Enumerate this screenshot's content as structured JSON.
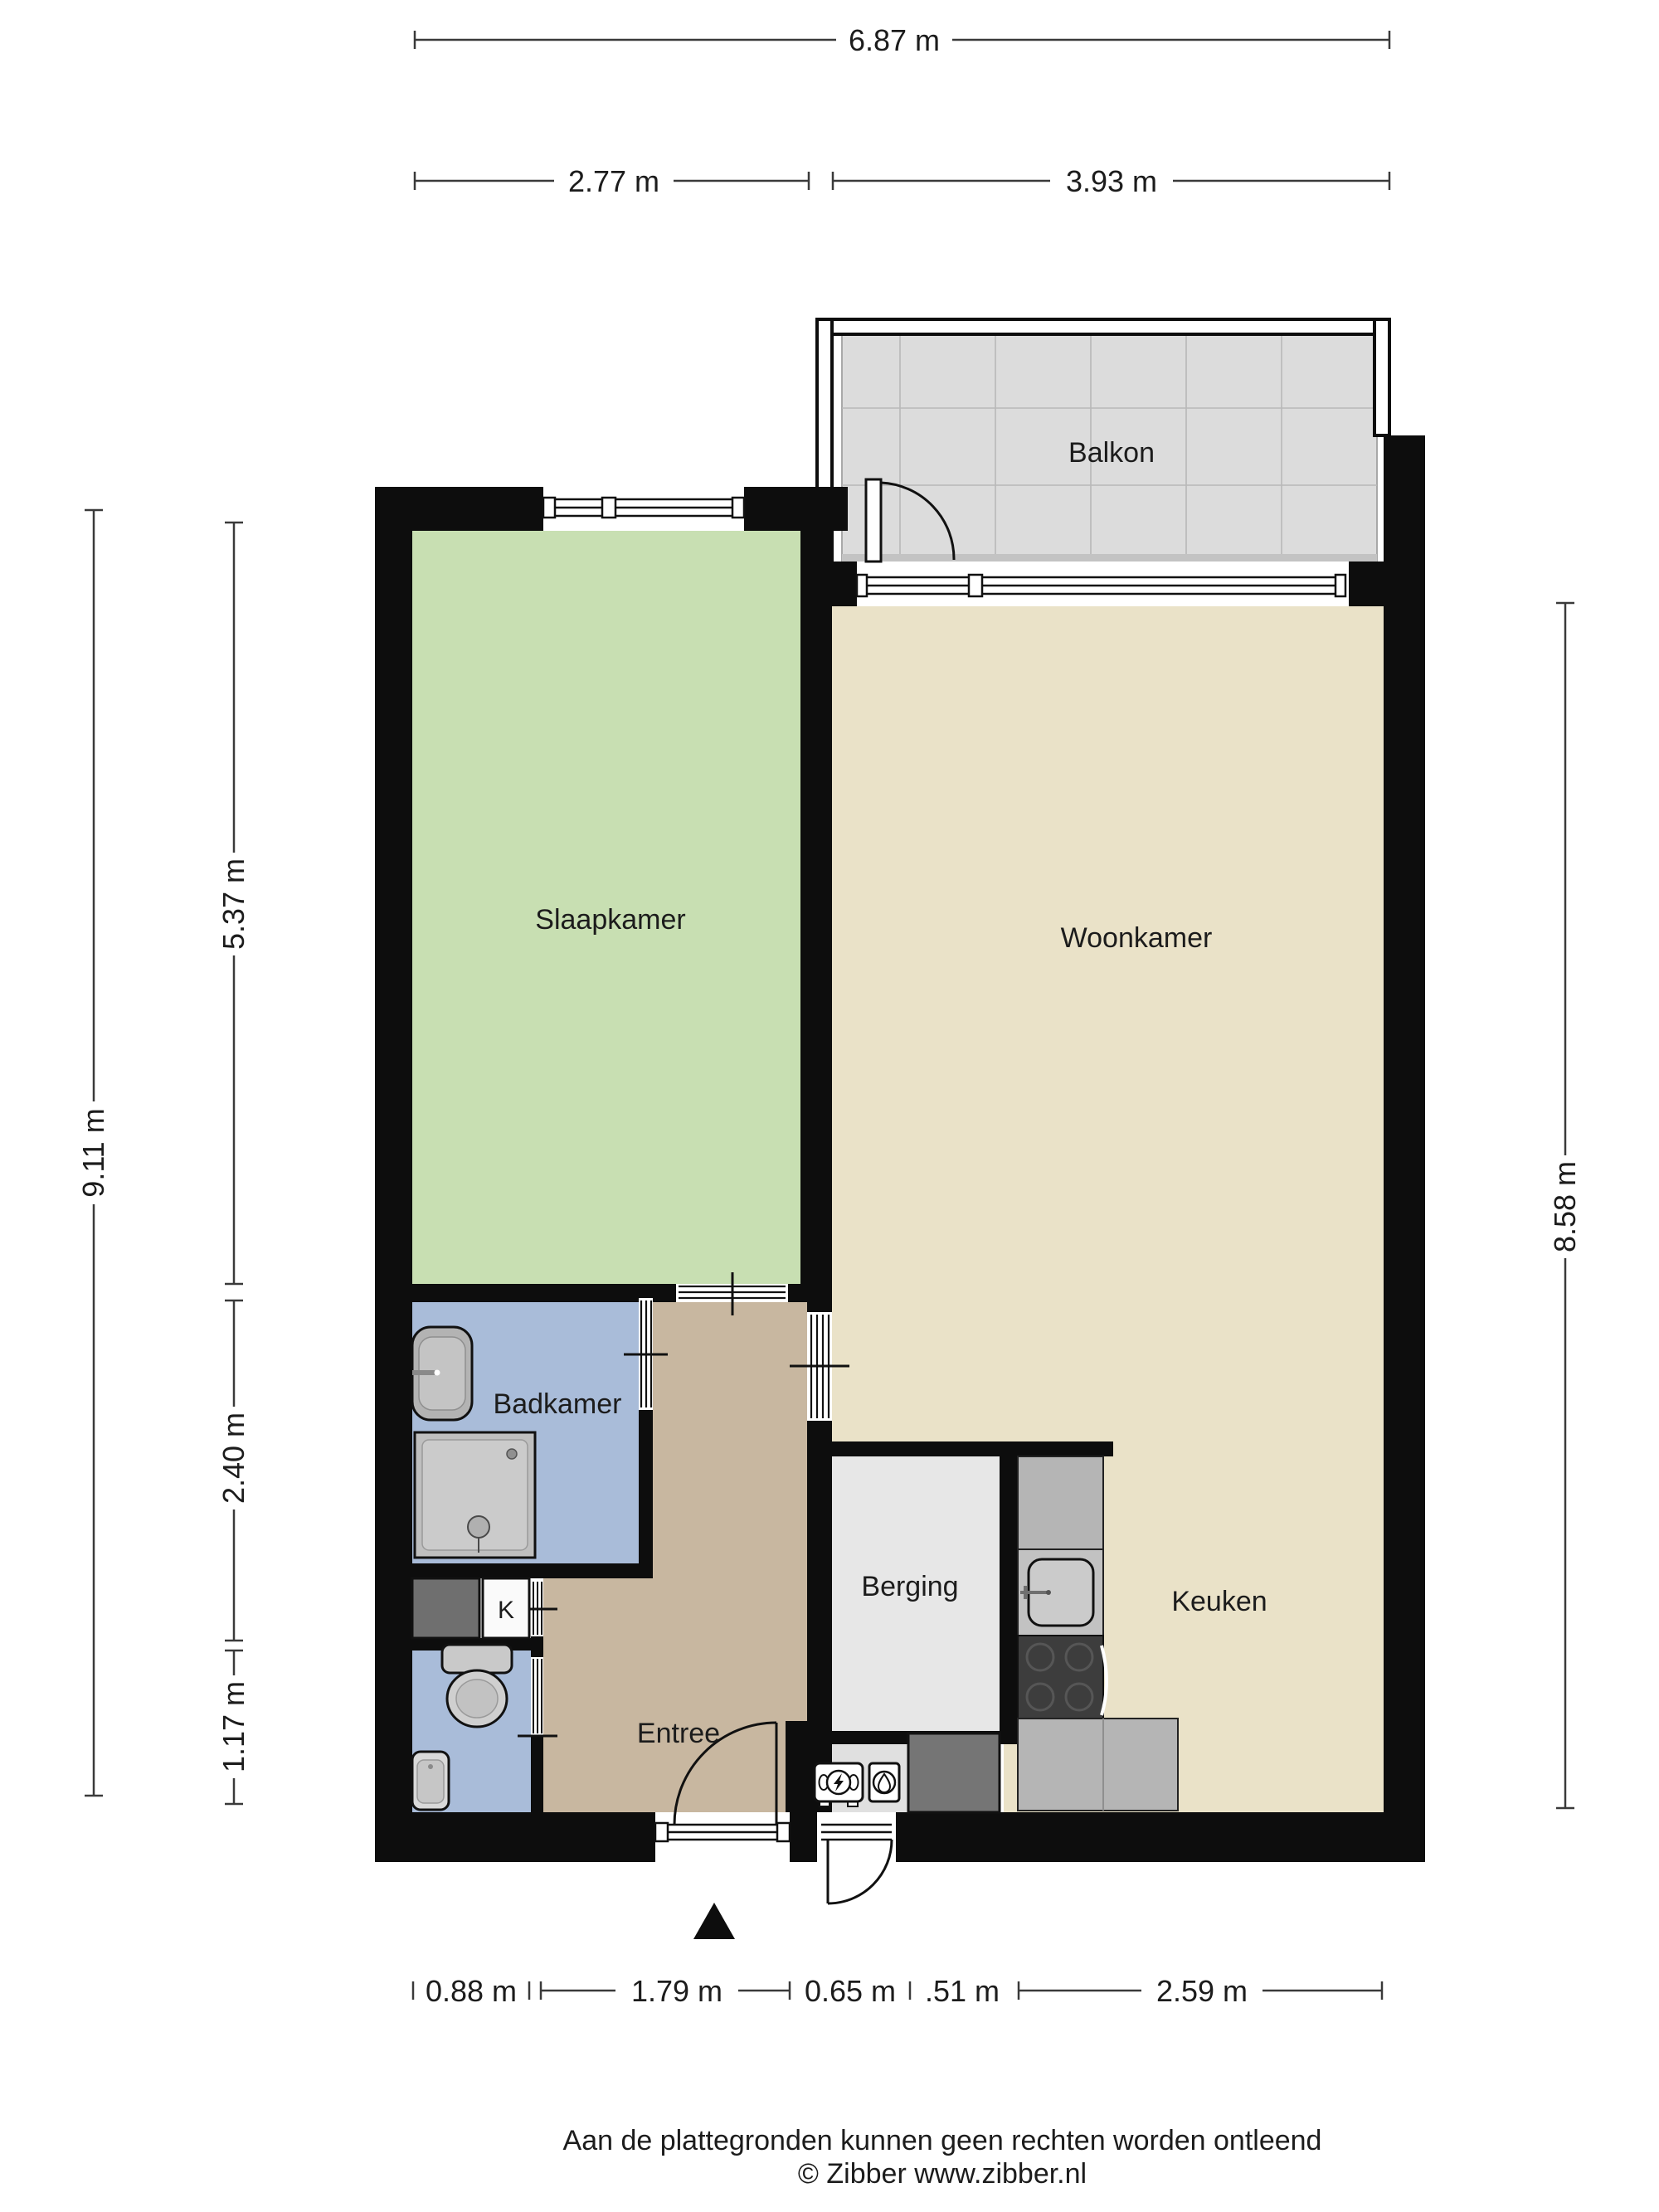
{
  "floorplan": {
    "rooms": {
      "balcony": {
        "label": "Balkon"
      },
      "bedroom": {
        "label": "Slaapkamer"
      },
      "living_room": {
        "label": "Woonkamer"
      },
      "bathroom": {
        "label": "Badkamer"
      },
      "storage": {
        "label": "Berging"
      },
      "kitchen": {
        "label": "Keuken"
      },
      "hallway": {
        "label": "Entree"
      },
      "closet": {
        "label": "K"
      }
    },
    "dimensions": {
      "top_total": "6.87 m",
      "top_left": "2.77 m",
      "top_right": "3.93 m",
      "left_total": "9.11 m",
      "left_upper": "5.37 m",
      "left_middle": "2.40 m",
      "left_lower": "1.17 m",
      "right_total": "8.58 m",
      "bottom": [
        "0.88 m",
        "1.79 m",
        "0.65 m",
        ".51 m",
        "2.59 m"
      ]
    },
    "colors": {
      "wall": "#0d0d0d",
      "bedroom": "#c8dfb2",
      "living": "#eae2c8",
      "hall": "#c8b7a0",
      "bath": "#a9bcd9",
      "storage": "#e7e7e7",
      "balcony": "#dcdcdc",
      "counter": "#b5b5b5",
      "stove": "#3d3d3d",
      "appliance": "#6f6f6f",
      "shaft": "#757575"
    },
    "icons": {
      "north_arrow": "north-arrow-triangle",
      "electric_meter": "electric-meter",
      "gas_meter": "gas-meter"
    },
    "footer": {
      "disclaimer": "Aan de plattegronden kunnen geen rechten worden ontleend",
      "credit": "© Zibber www.zibber.nl"
    }
  }
}
